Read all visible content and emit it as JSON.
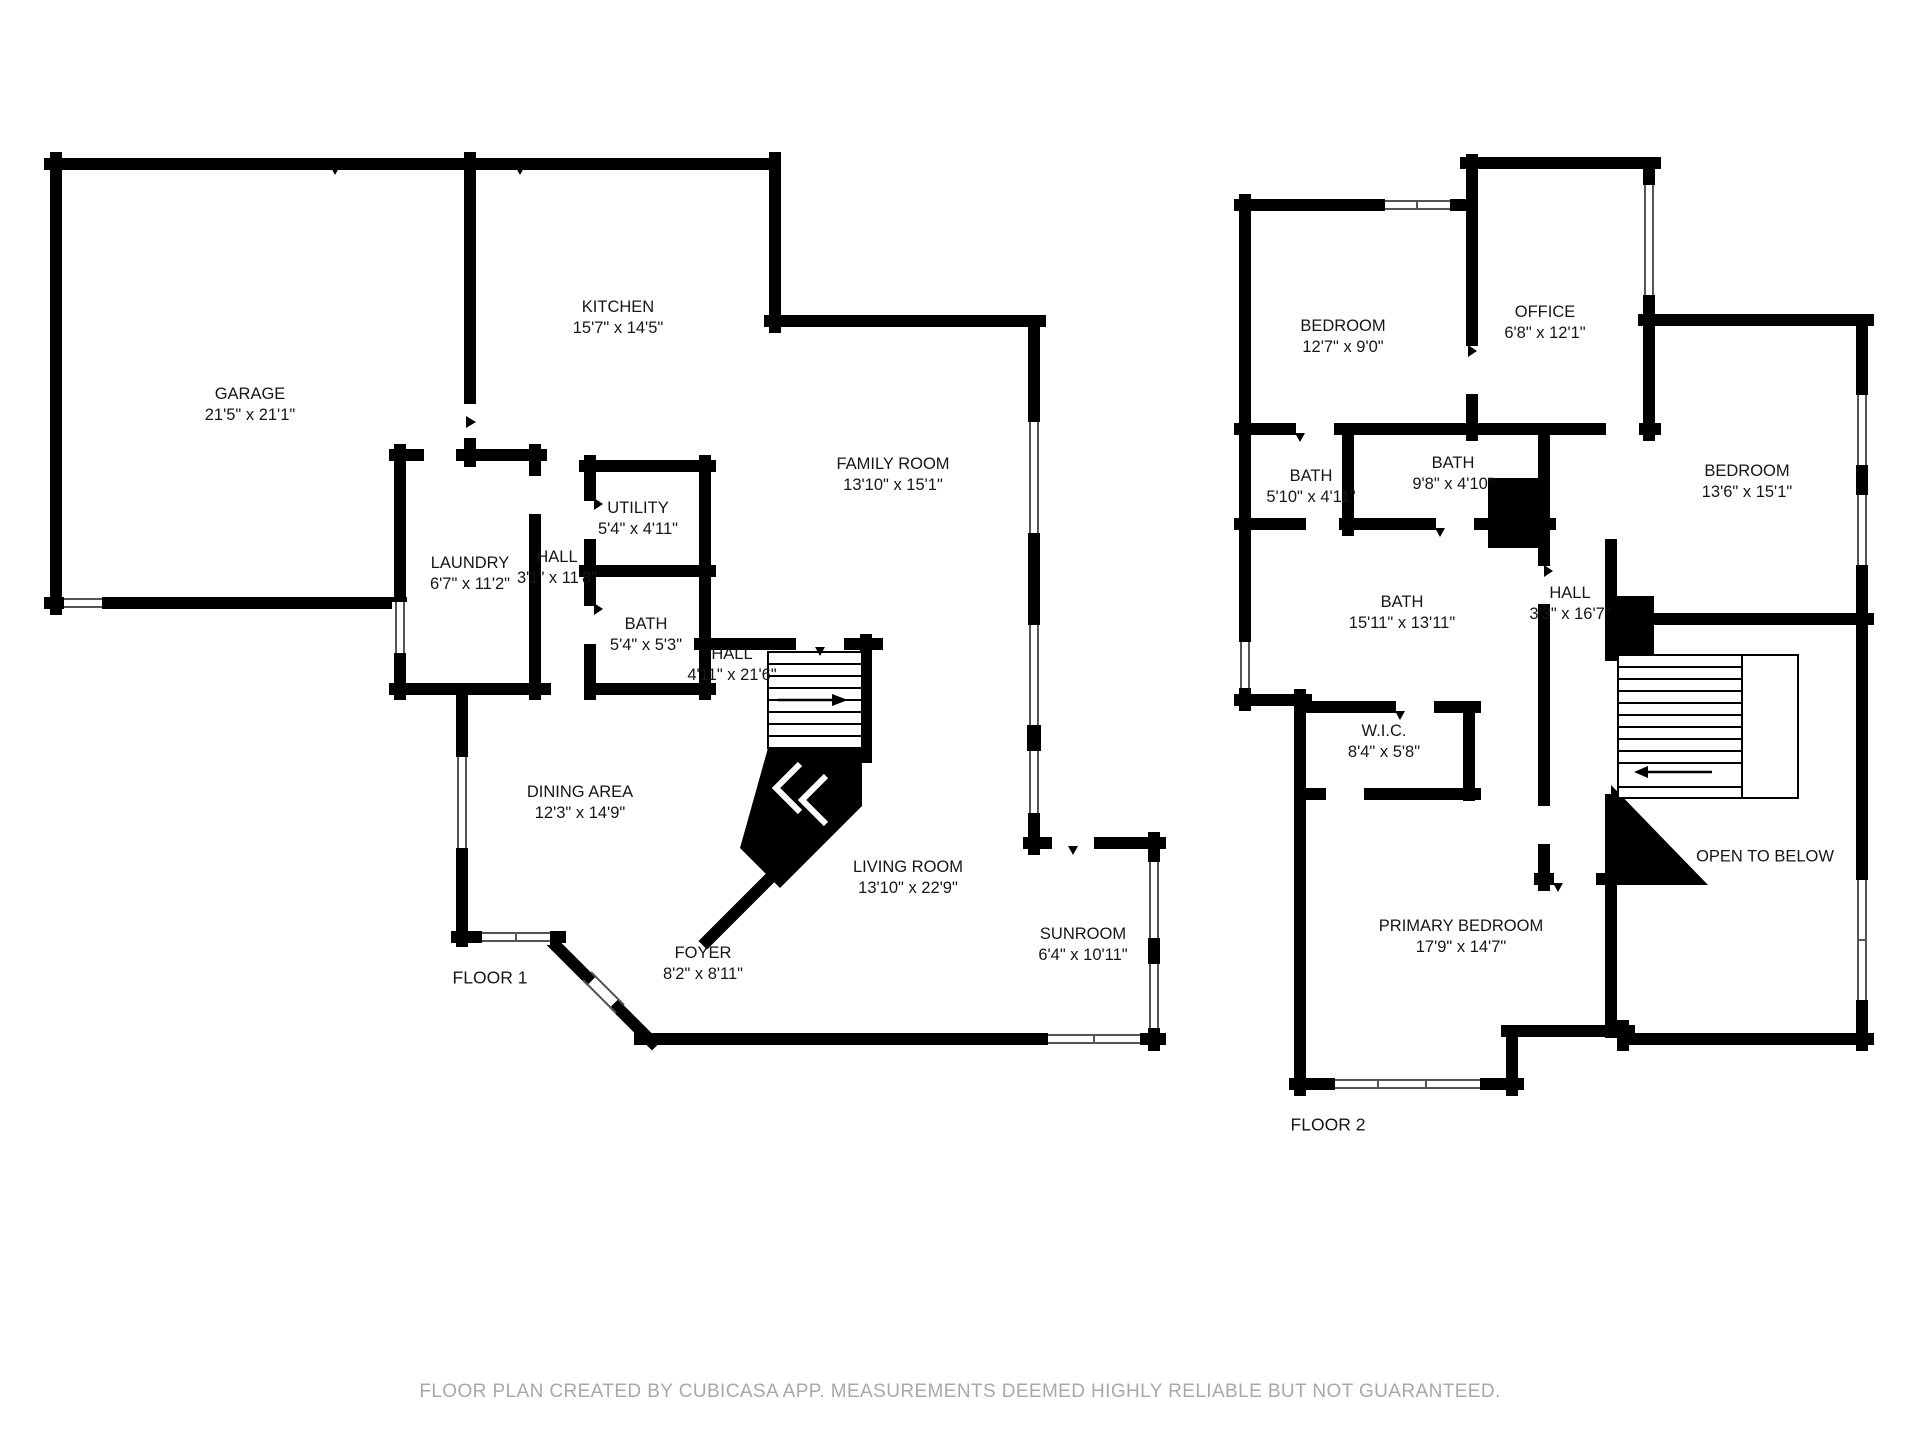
{
  "document_type": "floor-plan",
  "floors": [
    {
      "label": "FLOOR 1",
      "rooms": [
        {
          "name": "GARAGE",
          "dims": "21'5\" x 21'1\""
        },
        {
          "name": "KITCHEN",
          "dims": "15'7\" x 14'5\""
        },
        {
          "name": "FAMILY ROOM",
          "dims": "13'10\" x 15'1\""
        },
        {
          "name": "UTILITY",
          "dims": "5'4\" x 4'11\""
        },
        {
          "name": "LAUNDRY",
          "dims": "6'7\" x 11'2\""
        },
        {
          "name": "HALL",
          "dims": "3'1\" x 11'8\""
        },
        {
          "name": "BATH",
          "dims": "5'4\" x 5'3\""
        },
        {
          "name": "HALL",
          "dims": "4'11\" x 21'6\""
        },
        {
          "name": "DINING AREA",
          "dims": "12'3\" x 14'9\""
        },
        {
          "name": "LIVING ROOM",
          "dims": "13'10\" x 22'9\""
        },
        {
          "name": "FOYER",
          "dims": "8'2\" x 8'11\""
        },
        {
          "name": "SUNROOM",
          "dims": "6'4\" x 10'11\""
        }
      ]
    },
    {
      "label": "FLOOR 2",
      "rooms": [
        {
          "name": "BEDROOM",
          "dims": "12'7\" x 9'0\""
        },
        {
          "name": "OFFICE",
          "dims": "6'8\" x 12'1\""
        },
        {
          "name": "BATH",
          "dims": "5'10\" x 4'11\""
        },
        {
          "name": "BATH",
          "dims": "9'8\" x 4'10\""
        },
        {
          "name": "BEDROOM",
          "dims": "13'6\" x 15'1\""
        },
        {
          "name": "BATH",
          "dims": "15'11\" x 13'11\""
        },
        {
          "name": "HALL",
          "dims": "3'3\" x 16'7\""
        },
        {
          "name": "W.I.C.",
          "dims": "8'4\" x 5'8\""
        },
        {
          "name": "OPEN TO BELOW",
          "dims": ""
        },
        {
          "name": "PRIMARY BEDROOM",
          "dims": "17'9\" x 14'7\""
        }
      ]
    }
  ],
  "footer": "FLOOR PLAN CREATED BY CUBICASA APP. MEASUREMENTS DEEMED HIGHLY RELIABLE BUT NOT GUARANTEED.",
  "colors": {
    "wall": "#000000",
    "window_line": "#555555",
    "label_text": "#161616",
    "footer_text": "#a8a8a8",
    "background": "#ffffff"
  }
}
